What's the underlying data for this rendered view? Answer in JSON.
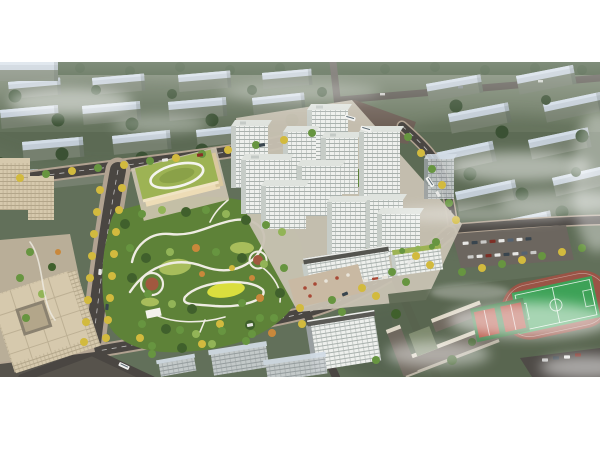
{
  "image": {
    "kind": "architectural aerial rendering",
    "subject": "masterplan bird's-eye view: white residential towers around a landscaped central park, kindergarten with green roof, retail street, office block, school campus with sports field, set in a hazy desaturated city context with fog",
    "visible_text": ""
  },
  "palette": {
    "page_bg": "#ffffff",
    "ground": "#62705a",
    "ground_top": "#7d8b74",
    "bg_roof": "#c3cdd7",
    "bg_roof_bright": "#d3dde7",
    "bg_face": "#76806f",
    "bg_tree": "#3b5134",
    "road": "#4a4642",
    "road_bg": "#5d5952",
    "junction": "#6e6057",
    "sidewalk": "#b1a291",
    "parking": "#6c665f",
    "path": "#efece3",
    "tree_yellow": "#d2ba3e",
    "tree_orange": "#c9883b",
    "tree_green": "#679540",
    "tree_green_dark": "#40602c",
    "tree_green_light": "#92b457",
    "park_base": "#5e8238",
    "lawn": "#a8bd5b",
    "lawn_bright": "#dade3e",
    "playground": "#a1583f",
    "kg_roof": "#9db354",
    "kg_wall": "#eddcb6",
    "tower_face": "#eef0ed",
    "tower_side": "#c6ccc7",
    "tower_roof": "#dfe3de",
    "tower_win": "#a9b1ad",
    "shop_red": "#a84936",
    "plaza": "#c9b9a3",
    "pavement": "#c8c2b3",
    "office": "#d6c9ad",
    "office_dark": "#b3a68a",
    "school_wall": "#ddd6c6",
    "school_roof": "#6f685e",
    "field_green": "#3da257",
    "track_red": "#9a5446",
    "court_red": "#b24b3a",
    "muted_face": "#ccd1d3",
    "muted_win": "#9aa1a4",
    "muted_side": "#9aa0a2",
    "fog": "#ffffff"
  },
  "elements": [
    "background-cityscape",
    "fog-clouds",
    "road-network",
    "tree-lined-avenue",
    "central-park",
    "kindergarten-building",
    "residential-towers",
    "retail-podium",
    "courtyard-gardens",
    "office-building",
    "school-campus",
    "sports-field",
    "basketball-courts",
    "parking-lot",
    "vehicles"
  ]
}
